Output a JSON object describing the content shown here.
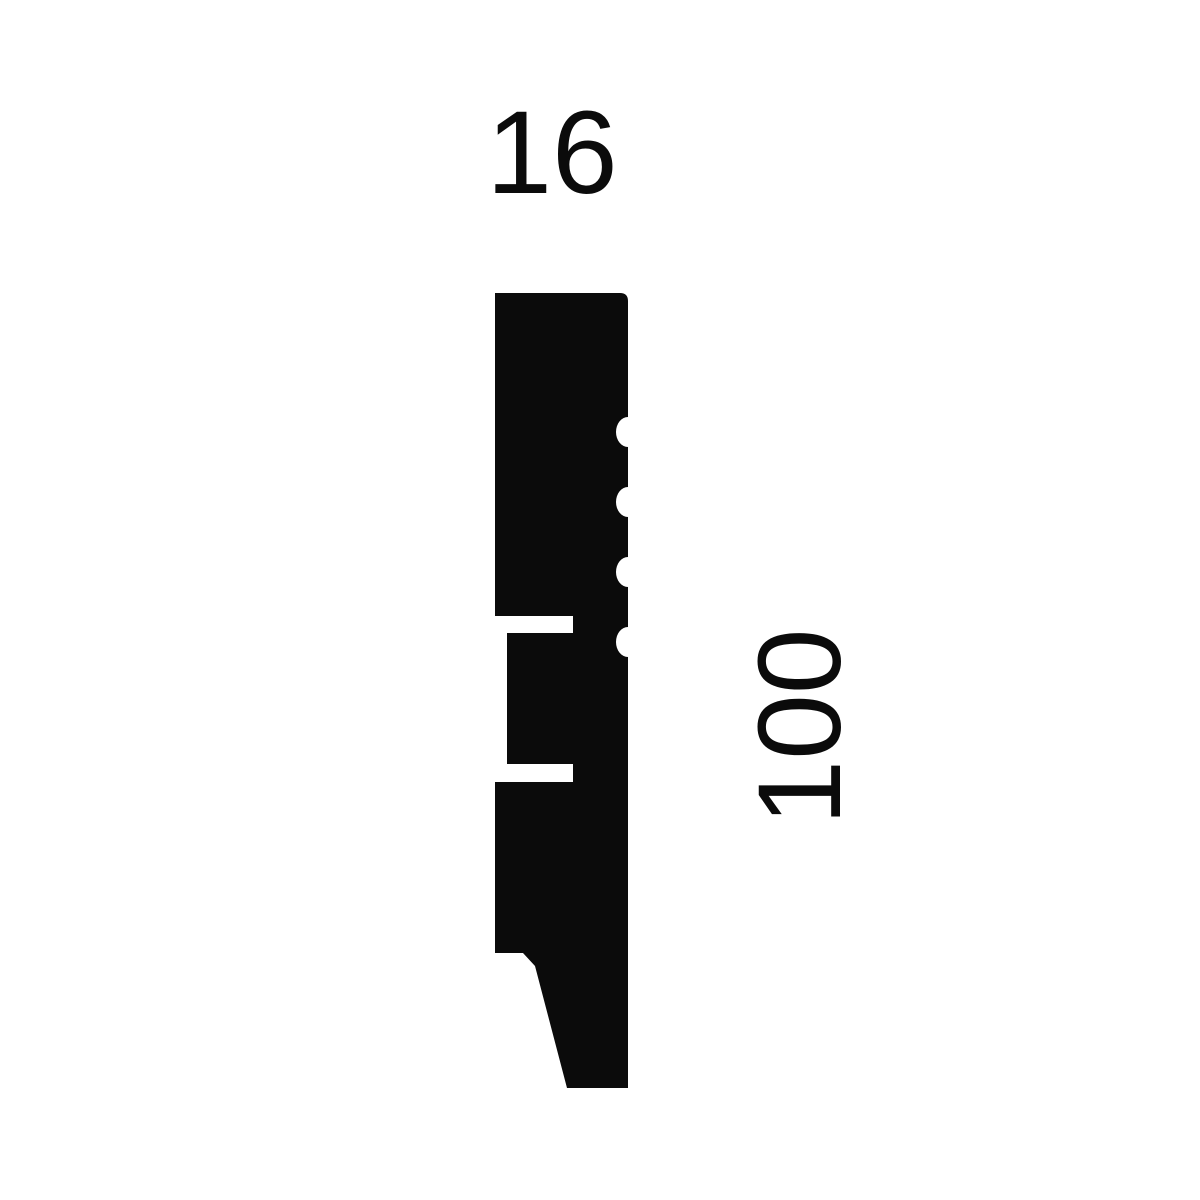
{
  "page": {
    "background_color": "#ffffff"
  },
  "diagram": {
    "type": "moulding-profile-cross-section",
    "shape_color": "#0b0b0b",
    "labels": {
      "width": "16",
      "height": "100"
    }
  }
}
